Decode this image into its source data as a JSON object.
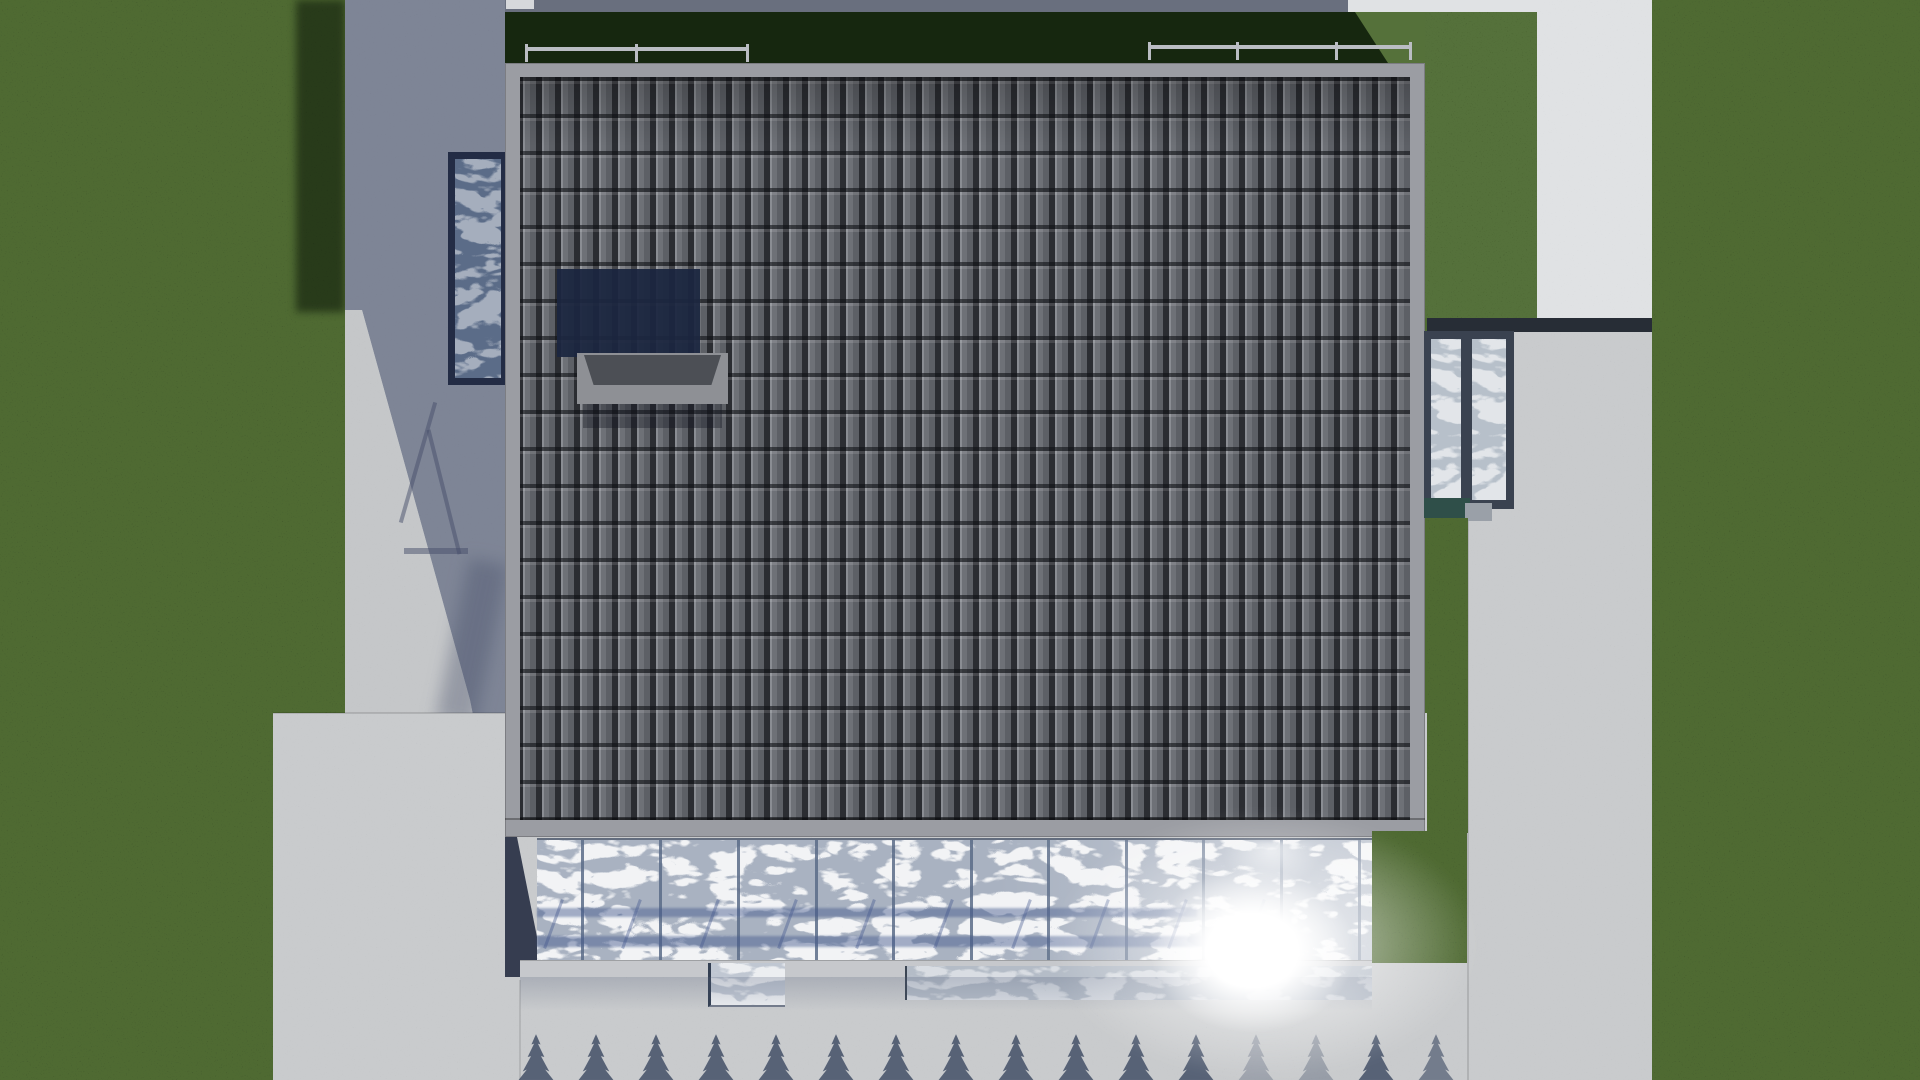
{
  "meta": {
    "description": "Top-down aerial 3D architectural rendering: modern house with dark grey tiled roof, rooftop skylight box with cast shadow, balcony railings, glass conservatory with tree reflections and sun glare, concrete paths, patios and lawns with a row of conifer tree shadows",
    "view": "top-down orthographic"
  },
  "palette": {
    "grass": "#4f6a33",
    "grass_bright": "#55713a",
    "grass_dark": "#16270f",
    "concrete": "#c9cbcd",
    "concrete_light": "#c5c7c9",
    "concrete_bright": "#e0e2e4",
    "concrete_shadow": "#7e8596",
    "concrete_top_shadow": "#696f7e",
    "white_object": "#d6d8db",
    "fascia": "#9b9da3",
    "chimney_shadow": "#1c2640",
    "cap_light": "#8e9095",
    "cap_dark": "#4c4f55",
    "glass": "#a9b2c1",
    "glass_lower": "#b4bcc7",
    "glass_piece": "#c0c7d2",
    "mullion": "#5a6b87",
    "sill": "#c6c8cc",
    "canopy_frame": "#3a4250",
    "canopy_glass": "#b7c0ca",
    "teal_band": "#2f4f49",
    "step": "#9aa0a8",
    "dark_band": "#272d36",
    "left_canopy_frame": "#232c45",
    "left_canopy_glass": "#5b6c88",
    "railing": "#babdc3",
    "tree_shadow": "#3b4861",
    "glow": "#ffffff"
  },
  "railings": {
    "bar_y": 46,
    "segments": [
      {
        "x": 526,
        "y": 47,
        "w": 222,
        "posts": [
          525,
          635,
          746
        ]
      },
      {
        "x": 1149,
        "y": 45,
        "w": 263,
        "posts": [
          1148,
          1236,
          1335,
          1409
        ]
      }
    ]
  },
  "conservatory": {
    "glass_x": 537,
    "glass_y": 838,
    "glass_w": 835,
    "glass_h": 124,
    "mullion_xs": [
      581,
      659,
      737,
      815,
      892,
      970,
      1047,
      1125,
      1202,
      1280,
      1358
    ],
    "shadow_diagonals": {
      "start_x": 552,
      "spacing": 78,
      "count": 10,
      "y": 896
    }
  },
  "trees": {
    "y": 1034,
    "w": 38,
    "h": 48,
    "xs": [
      517,
      577,
      637,
      697,
      757,
      817,
      877,
      937,
      997,
      1057,
      1117,
      1177,
      1237,
      1297,
      1357,
      1417
    ],
    "opacity_default": 0.8,
    "opacity_overrides": {
      "12": 0.3,
      "13": 0.35,
      "15": 0.6
    }
  },
  "counts": {
    "railing_segments": 2,
    "conservatory_mullions": 11,
    "tree_shadows": 16
  }
}
